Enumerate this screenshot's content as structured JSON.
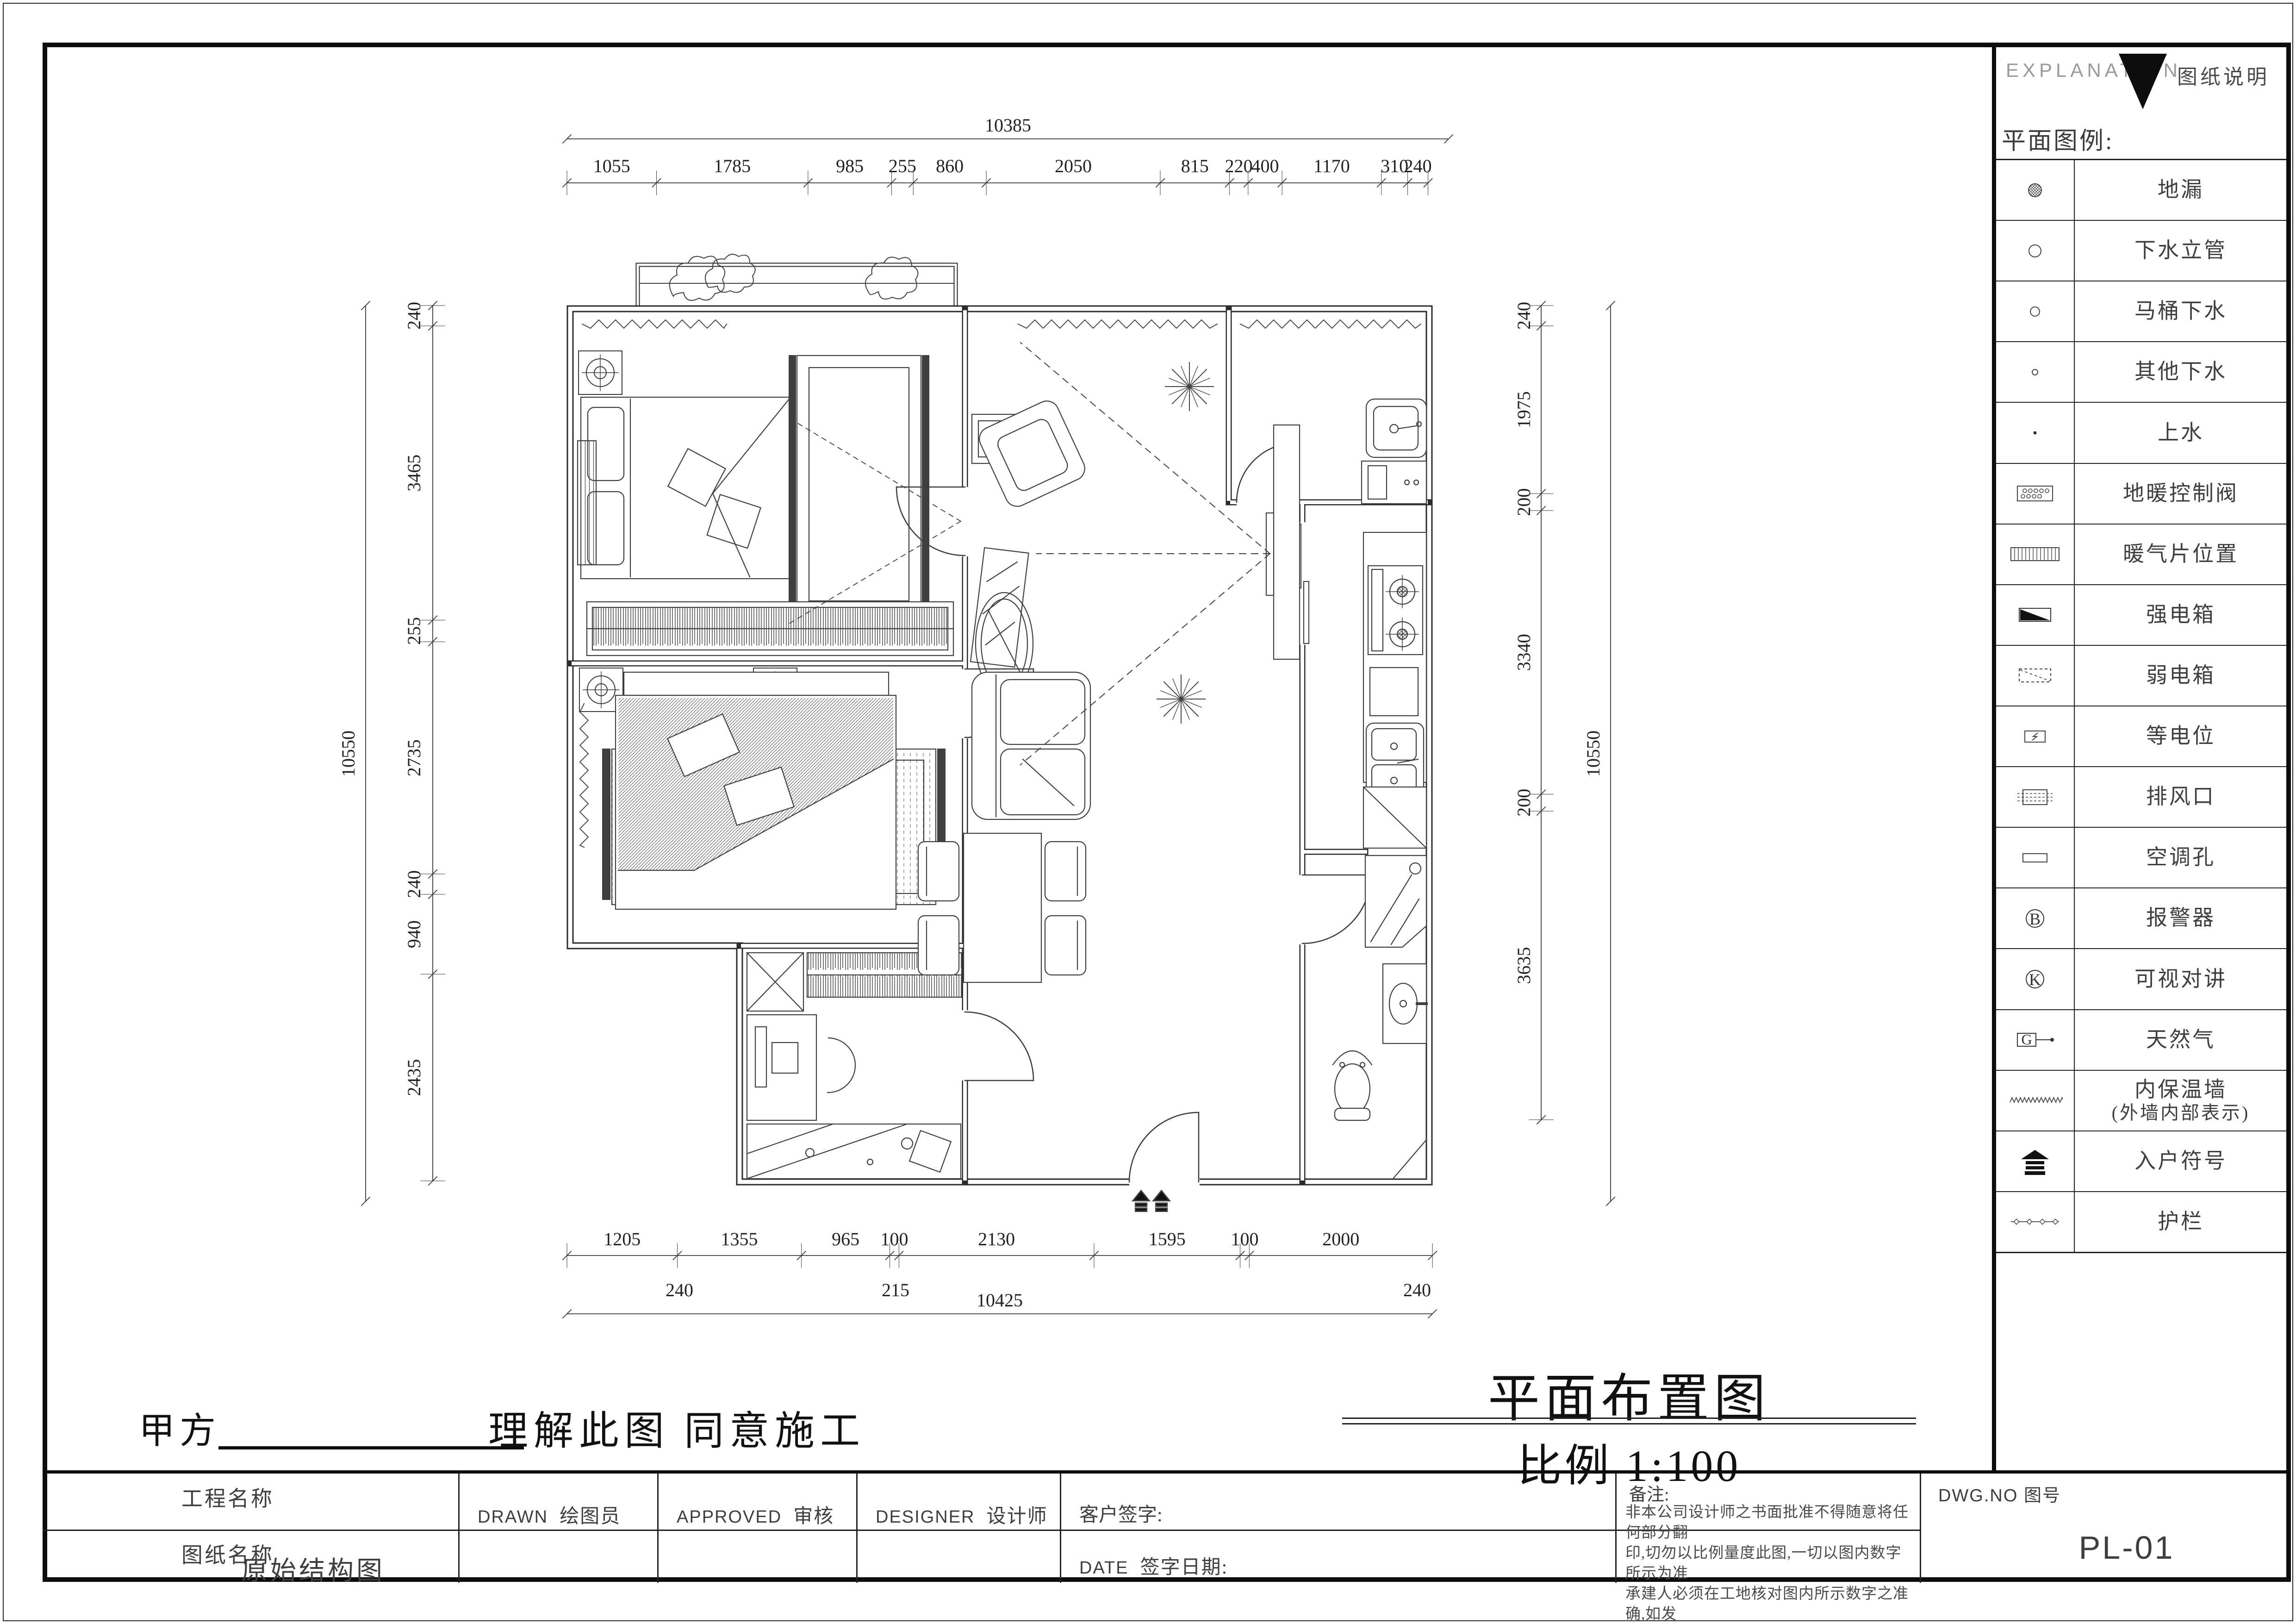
{
  "legend": {
    "header_en": "EXPLANATION",
    "header_cn": "图纸说明",
    "title": "平面图例:",
    "rows": [
      {
        "icon": "floor-drain",
        "label": "地漏"
      },
      {
        "icon": "drain-riser",
        "label": "下水立管"
      },
      {
        "icon": "toilet-drain",
        "label": "马桶下水"
      },
      {
        "icon": "other-drain",
        "label": "其他下水"
      },
      {
        "icon": "water-supply",
        "label": "上水"
      },
      {
        "icon": "floor-heating-valve",
        "label": "地暖控制阀"
      },
      {
        "icon": "radiator-position",
        "label": "暖气片位置"
      },
      {
        "icon": "strong-power-box",
        "label": "强电箱"
      },
      {
        "icon": "weak-power-box",
        "label": "弱电箱"
      },
      {
        "icon": "equipotential",
        "label": "等电位"
      },
      {
        "icon": "exhaust-vent",
        "label": "排风口"
      },
      {
        "icon": "ac-hole",
        "label": "空调孔"
      },
      {
        "icon": "alarm",
        "label": "报警器",
        "letter": "B"
      },
      {
        "icon": "video-intercom",
        "label": "可视对讲",
        "letter": "K"
      },
      {
        "icon": "gas",
        "label": "天然气",
        "letter": "G"
      },
      {
        "icon": "insulation-wall",
        "label": "内保温墙",
        "label2": "(外墙内部表示)"
      },
      {
        "icon": "entry-symbol",
        "label": "入户符号"
      },
      {
        "icon": "guardrail",
        "label": "护栏"
      }
    ]
  },
  "plan_title": {
    "main": "平面布置图",
    "scale": "比例  1:100"
  },
  "signoff": {
    "party_a": "甲方",
    "understand": "理解此图",
    "agree": "同意施工"
  },
  "titleblock": {
    "project_label": "工程名称",
    "drawing_label": "图纸名称",
    "drawing_name": "原始结构图",
    "drawn_en": "DRAWN",
    "drawn_cn": "绘图员",
    "approved_en": "APPROVED",
    "approved_cn": "审核",
    "designer_en": "DESIGNER",
    "designer_cn": "设计师",
    "client_sign": "客户签字:",
    "date_en": "DATE",
    "date_cn": "签字日期:",
    "notes_label": "备注:",
    "notes_lines": [
      "非本公司设计师之书面批准不得随意将任何部分翻",
      "印,切勿以比例量度此图,一切以图内数字所示为准",
      "承建人必须在工地核对图内所示数字之准确,如发",
      "现有矛盾处,应立即通知设计师,图纸版权归本公司"
    ],
    "dwg_label": "DWG.NO  图号",
    "dwg_no": "PL-01"
  },
  "dimensions": {
    "top": {
      "overall": 10385,
      "segments": [
        1055,
        1785,
        985,
        255,
        860,
        2050,
        815,
        220,
        400,
        1170,
        310,
        240
      ]
    },
    "left": {
      "overall": 10550,
      "segments": [
        240,
        3465,
        255,
        2735,
        240,
        940,
        2435
      ]
    },
    "right": {
      "overall": 10550,
      "segments": [
        240,
        1975,
        200,
        3340,
        200,
        3635
      ]
    },
    "bottom": {
      "overall": 10425,
      "segments": [
        1205,
        1355,
        965,
        100,
        2130,
        1595,
        100,
        2000
      ],
      "inner": [
        240,
        215,
        240
      ]
    }
  }
}
